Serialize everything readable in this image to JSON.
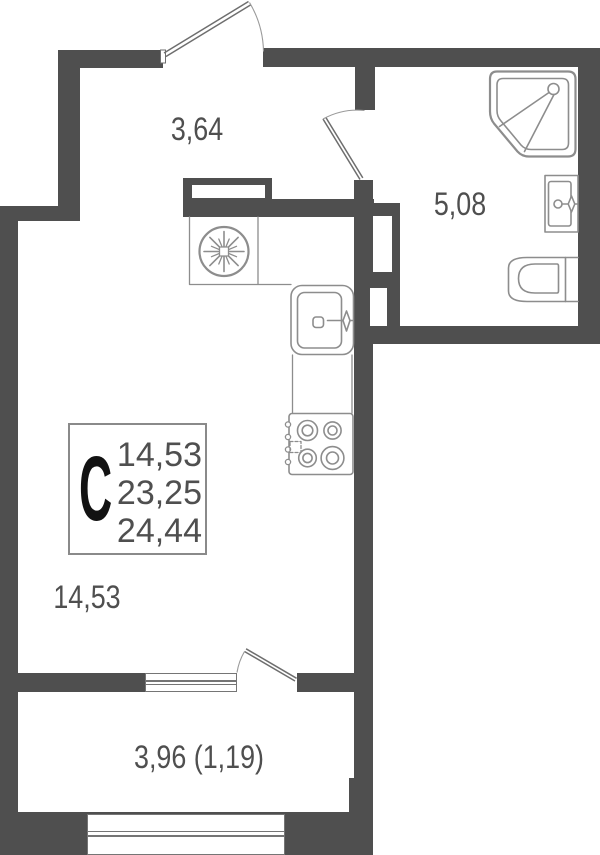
{
  "plan": {
    "unit": {
      "letter": "С",
      "area_lines": [
        "14,53",
        "23,25",
        "24,44"
      ]
    },
    "rooms": {
      "hall": {
        "area": "3,64"
      },
      "bathroom": {
        "area": "5,08"
      },
      "living": {
        "area": "14,53"
      },
      "balcony": {
        "area": "3,96 (1,19)"
      }
    },
    "fixtures": [
      "shower-cabin",
      "washbasin",
      "toilet",
      "kitchen-sink",
      "cooktop",
      "ventilation-fan"
    ],
    "colors": {
      "wall": "#4f4f4f",
      "fixture_line": "#8d8d8d",
      "door_line": "#6e6e6e",
      "arc_line": "#9a9a9a",
      "window_line": "#757575",
      "text": "#4f4f4f",
      "unit_letter": "#121212",
      "background": "#ffffff"
    }
  }
}
